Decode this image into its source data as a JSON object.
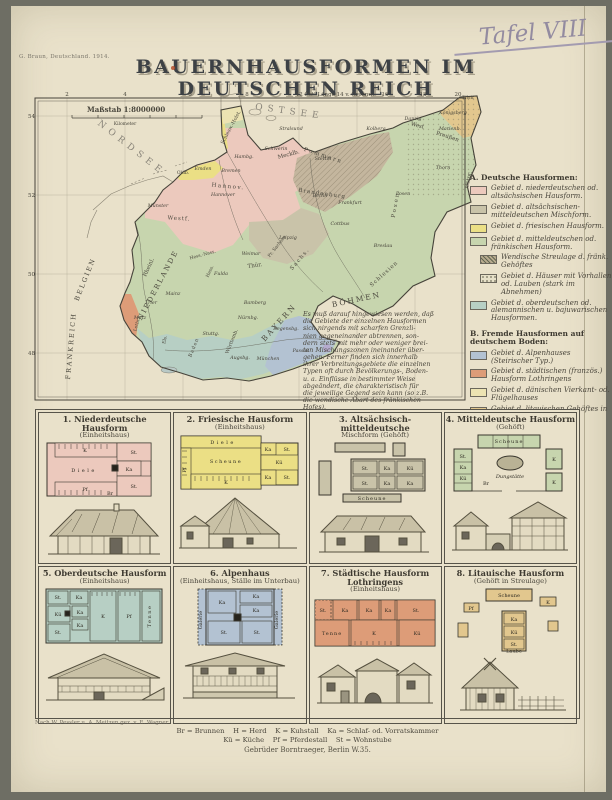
{
  "page": {
    "imprint": "G. Braun, Deutschland. 1914.",
    "tafel": "Tafel VIII",
    "title": "BAUERNHAUSFORMEN IM DEUTSCHEN REICH"
  },
  "map": {
    "scale_label": "Maßstab 1:8000000",
    "km_label": "Kilometer",
    "lon_labels": [
      "2",
      "4",
      "6",
      "8",
      "12 Östl.Länge 14 v. Greenw.",
      "16",
      "18",
      "20"
    ],
    "lat_labels": [
      "54",
      "52",
      "50",
      "48"
    ],
    "seas": {
      "north": "NORDSEE",
      "baltic": "OSTSEE"
    },
    "countries": [
      "NIEDERLANDE",
      "BELGIEN",
      "FRANKREICH",
      "BÖHMEN"
    ],
    "regions": [
      "Schlesw.-Holst.",
      "Mecklb.",
      "Pommern",
      "West",
      "Preußen",
      "Ostpr.",
      "Hannov.",
      "Oldb.",
      "Westf.",
      "Brandenburg",
      "Posen",
      "Schlesien",
      "Pr. Sachsen",
      "Hess.-Nass.",
      "Hess.",
      "Thür.",
      "Sachs.",
      "Rheinl.",
      "B A Y E R N",
      "Württemb.",
      "Baden",
      "Els.",
      "Lothr."
    ],
    "cities": [
      "Emden",
      "Bremen",
      "Hambg.",
      "Hannover",
      "Münster",
      "Schwerin",
      "Stralsund",
      "Stettin",
      "Kolberg",
      "Danzig",
      "Königsberg",
      "Tilsit",
      "Marienb.",
      "Thorn",
      "Posen",
      "Berlin",
      "Frankfurt",
      "Cottbus",
      "Leipzig",
      "Weimar",
      "Fulda",
      "Mainz",
      "Trier",
      "Metz",
      "Bamberg",
      "Nürnbg.",
      "Regensbg.",
      "Passau",
      "München",
      "Augsbg.",
      "Stuttg.",
      "Breslau"
    ],
    "note": "Es muß darauf hingewiesen werden, daß\ndie Gebiete der einzelnen Hausformen\nsich nirgends mit scharfen Grenzli-\nnien gegeneinander abtrennen, son-\ndern stets mit mehr oder weniger brei-\nten Mischungszonen ineinander über-\ngehen. Ferner finden sich innerhalb\nihrer Verbreitungsgebiete die einzelnen\nTypen oft durch Bevölkerungs-, Boden-\nu. a. Einflüsse in bestimmter Weise\nabgeändert, die charakteristisch für\ndie jeweilige Gegend sein kann (so z.B.\ndie wendische Abart des fränkischen\nHofes).",
    "legend_a": {
      "title": "A. Deutsche Hausformen:",
      "items": [
        {
          "color": "#ecc9bd",
          "label": "Gebiet d. niederdeutschen od. altsächsischen Hausform."
        },
        {
          "color": "#c9c3a9",
          "label": "Gebiet d. altsächsischen-mitteldeutschen Mischform."
        },
        {
          "color": "#ebdf85",
          "label": "Gebiet d. friesischen Hausform."
        },
        {
          "color": "#c7d5ae",
          "label": "Gebiet d. mitteldeutschen od. fränkischen Hausform."
        },
        {
          "color": "#b8ab8f",
          "label": "Wendische Streulage d. fränk. Gehöftes"
        },
        {
          "color": "#e6e0c8",
          "label": "Gebiet d. Häuser mit Vorhallen od. Lauben (stark im Abnehmen)"
        },
        {
          "color": "#b7cfc4",
          "label": "Gebiet d. oberdeutschen od. alemannischen u. bajuwarischen Hausformen."
        }
      ]
    },
    "legend_b": {
      "title": "B. Fremde Hausformen auf deutschem Boden:",
      "items": [
        {
          "color": "#b3c2d2",
          "label": "Gebiet d. Alpenhauses (Steirischer Typ.)"
        },
        {
          "color": "#dd9c78",
          "label": "Gebiet d. städtischen (französ.) Hausform Lothringens"
        },
        {
          "color": "#ece3b2",
          "label": "Gebiet d. dänischen Vierkant- od. Flügelhauses"
        },
        {
          "color": "#e2c78e",
          "label": "Gebiet d. litauischen Gehöftes in Streulage"
        }
      ]
    }
  },
  "panels": [
    {
      "title": "1. Niederdeutsche Hausform",
      "subtitle": "(Einheitshaus)",
      "labels": [
        "K",
        "Diele",
        "Pf",
        "St.",
        "Ka",
        "St.",
        "Br"
      ]
    },
    {
      "title": "2. Friesische Hausform",
      "subtitle": "(Einheitshaus)",
      "labels": [
        "Diele",
        "Scheune",
        "Pf",
        "K",
        "Ka",
        "St.",
        "Kü",
        "Ka",
        "St."
      ]
    },
    {
      "title": "3. Altsächsisch-mitteldeutsche",
      "subtitle": "Mischform (Gehöft)",
      "labels": [
        "St.",
        "Ka",
        "Kü",
        "St.",
        "Ka",
        "Ka",
        "Scheune"
      ]
    },
    {
      "title": "4. Mitteldeutsche Hausform",
      "subtitle": "(Gehöft)",
      "labels": [
        "Scheune",
        "St.",
        "Ka",
        "Kü",
        "K",
        "K",
        "Dungstätte",
        "Br"
      ]
    },
    {
      "title": "5. Oberdeutsche Hausform",
      "subtitle": "(Einheitshaus)",
      "labels": [
        "St.",
        "Ka",
        "Kü",
        "St.",
        "Ka",
        "Ka",
        "K",
        "Pf",
        "Tenne"
      ]
    },
    {
      "title": "6. Alpenhaus",
      "subtitle": "(Einheitshaus, Ställe im Unterbau)",
      "labels": [
        "Galerie",
        "Ka",
        "Ka",
        "Ka",
        "St.",
        "St.",
        "Galerie"
      ]
    },
    {
      "title": "7. Städtische Hausform Lothringens",
      "subtitle": "(Einheitshaus)",
      "labels": [
        "St.",
        "Ka",
        "Ka",
        "Ka",
        "St.",
        "Tenne",
        "K",
        "Kü"
      ]
    },
    {
      "title": "8. Litauische Hausform",
      "subtitle": "(Gehöft in Streulage)",
      "labels": [
        "Scheune",
        "K",
        "Pf",
        "Ka",
        "Kü",
        "St.",
        "Laube"
      ]
    }
  ],
  "footer": {
    "credit": "Nach W. Pessler u. A. Meitzen gez. v. E. Wagner",
    "key_line1": "Br = Brunnen    H = Herd    K = Kuhstall    Ka = Schlaf- od. Vorratskammer",
    "key_line2": "Kü = Küche    Pf = Pferdestall    St = Wohnstube",
    "publisher": "Gebrüder Borntraeger, Berlin W.35."
  }
}
